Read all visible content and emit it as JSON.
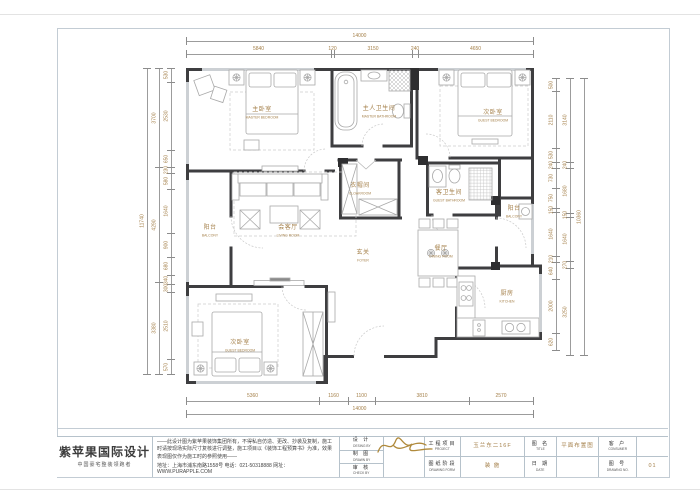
{
  "plan": {
    "dim_color": "#a5814b",
    "rooms": [
      {
        "zh": "主卧室",
        "en": "MASTER BEDROOM",
        "x": 262,
        "y": 113
      },
      {
        "zh": "主人卫生间",
        "en": "MASTER BATHROOM",
        "x": 379,
        "y": 112
      },
      {
        "zh": "次卧室",
        "en": "GUEST BEDROOM",
        "x": 493,
        "y": 116
      },
      {
        "zh": "衣帽间",
        "en": "CLOAKROOM",
        "x": 360,
        "y": 189
      },
      {
        "zh": "客卫生间",
        "en": "GUEST BATHROOM",
        "x": 449,
        "y": 196
      },
      {
        "zh": "阳台",
        "en": "BALCONY",
        "x": 210,
        "y": 231
      },
      {
        "zh": "会客厅",
        "en": "LIVING ROOM",
        "x": 288,
        "y": 231
      },
      {
        "zh": "玄关",
        "en": "FOYER",
        "x": 363,
        "y": 256
      },
      {
        "zh": "餐厅",
        "en": "DINING ROOM",
        "x": 441,
        "y": 252
      },
      {
        "zh": "阳台",
        "en": "BALCONY",
        "x": 514,
        "y": 212
      },
      {
        "zh": "次卧室",
        "en": "GUEST BEDROOM",
        "x": 240,
        "y": 346
      },
      {
        "zh": "厨房",
        "en": "KITCHEN",
        "x": 507,
        "y": 297
      }
    ],
    "dim_chains": [
      {
        "id": "top-total",
        "o": "h",
        "p": 41,
        "segs": [
          {
            "v": "14000",
            "a": 186,
            "b": 533
          }
        ]
      },
      {
        "id": "top-segments",
        "o": "h",
        "p": 54,
        "segs": [
          {
            "v": "5840",
            "a": 186,
            "b": 331
          },
          {
            "v": "120",
            "a": 331,
            "b": 334
          },
          {
            "v": "3150",
            "a": 334,
            "b": 412
          },
          {
            "v": "240",
            "a": 412,
            "b": 418
          },
          {
            "v": "4650",
            "a": 418,
            "b": 533
          }
        ]
      },
      {
        "id": "bottom-segments",
        "o": "h",
        "p": 401,
        "segs": [
          {
            "v": "5360",
            "a": 186,
            "b": 319
          },
          {
            "v": "1160",
            "a": 319,
            "b": 348
          },
          {
            "v": "1100",
            "a": 348,
            "b": 375
          },
          {
            "v": "3810",
            "a": 375,
            "b": 469
          },
          {
            "v": "2570",
            "a": 469,
            "b": 533
          }
        ]
      },
      {
        "id": "bottom-total",
        "o": "h",
        "p": 414,
        "segs": [
          {
            "v": "14000",
            "a": 186,
            "b": 533
          }
        ]
      },
      {
        "id": "left-total",
        "o": "v",
        "p": 147,
        "segs": [
          {
            "v": "11740",
            "a": 68,
            "b": 374
          }
        ]
      },
      {
        "id": "left-mid",
        "o": "v",
        "p": 159,
        "segs": [
          {
            "v": "3700",
            "a": 68,
            "b": 167
          },
          {
            "v": "4290",
            "a": 167,
            "b": 282
          },
          {
            "v": "3380",
            "a": 282,
            "b": 374
          }
        ]
      },
      {
        "id": "left-inner",
        "o": "v",
        "p": 171,
        "segs": [
          {
            "v": "530",
            "a": 68,
            "b": 82
          },
          {
            "v": "2530",
            "a": 82,
            "b": 150
          },
          {
            "v": "650",
            "a": 150,
            "b": 167
          },
          {
            "v": "230",
            "a": 167,
            "b": 173
          },
          {
            "v": "580",
            "a": 173,
            "b": 189
          },
          {
            "v": "1640",
            "a": 189,
            "b": 233
          },
          {
            "v": "900",
            "a": 233,
            "b": 257
          },
          {
            "v": "680",
            "a": 257,
            "b": 275
          },
          {
            "v": "340",
            "a": 275,
            "b": 284
          },
          {
            "v": "300",
            "a": 284,
            "b": 292
          },
          {
            "v": "2510",
            "a": 292,
            "b": 359
          },
          {
            "v": "570",
            "a": 359,
            "b": 374
          }
        ]
      },
      {
        "id": "right-inner",
        "o": "v",
        "p": 556,
        "segs": [
          {
            "v": "500",
            "a": 78,
            "b": 91
          },
          {
            "v": "2110",
            "a": 91,
            "b": 148
          },
          {
            "v": "530",
            "a": 148,
            "b": 162
          },
          {
            "v": "240",
            "a": 162,
            "b": 168
          },
          {
            "v": "730",
            "a": 168,
            "b": 188
          },
          {
            "v": "750",
            "a": 188,
            "b": 208
          },
          {
            "v": "150",
            "a": 208,
            "b": 212
          },
          {
            "v": "1640",
            "a": 212,
            "b": 256
          },
          {
            "v": "210",
            "a": 256,
            "b": 262
          },
          {
            "v": "640",
            "a": 262,
            "b": 279
          },
          {
            "v": "2000",
            "a": 279,
            "b": 333
          },
          {
            "v": "620",
            "a": 333,
            "b": 350
          }
        ]
      },
      {
        "id": "right-mid",
        "o": "v",
        "p": 570,
        "segs": [
          {
            "v": "3140",
            "a": 78,
            "b": 162
          },
          {
            "v": "240",
            "a": 162,
            "b": 168
          },
          {
            "v": "1680",
            "a": 168,
            "b": 213
          },
          {
            "v": "150",
            "a": 213,
            "b": 217
          },
          {
            "v": "1640",
            "a": 217,
            "b": 261
          },
          {
            "v": "270",
            "a": 261,
            "b": 268
          },
          {
            "v": "3250",
            "a": 268,
            "b": 355
          }
        ]
      },
      {
        "id": "right-total",
        "o": "v",
        "p": 584,
        "segs": [
          {
            "v": "10360",
            "a": 78,
            "b": 355
          }
        ]
      }
    ]
  },
  "title_block": {
    "brand": {
      "name": "紫苹果国际设计",
      "tagline": "中国豪宅整装领跑者"
    },
    "disclaimer": "——此设计图为紫苹果装饰集团所有，不得私自仿造、更改、抄袭及复制，施工时请按现场实际尺寸复核进行调整，施工项目以《装饰工程预算书》为准，效果表现图仅作为施工时的参照使用——",
    "contact": "地址：上海市浦东南路1558号  电话：021-50318888  网址：WWW.PURAPPLE.COM",
    "roles": [
      {
        "zh": "设 计",
        "en": "DESING BY"
      },
      {
        "zh": "制 图",
        "en": "DRAWN BY"
      },
      {
        "zh": "审 核",
        "en": "CHECK BY"
      }
    ],
    "fields": {
      "project": {
        "zh": "工程项目",
        "en": "PROJECT",
        "value": "玉兰东二16F"
      },
      "form": {
        "zh": "图纸阶段",
        "en": "DRAWING FORM",
        "value": "装 施"
      },
      "title": {
        "zh": "图 名",
        "en": "TITLE",
        "value": "平面布置图"
      },
      "date": {
        "zh": "日 期",
        "en": "DATE",
        "value": ""
      },
      "consumer": {
        "zh": "客 户",
        "en": "CONSUMER",
        "value": ""
      },
      "number": {
        "zh": "图 号",
        "en": "DRAWING NO.",
        "value": "01"
      }
    }
  }
}
